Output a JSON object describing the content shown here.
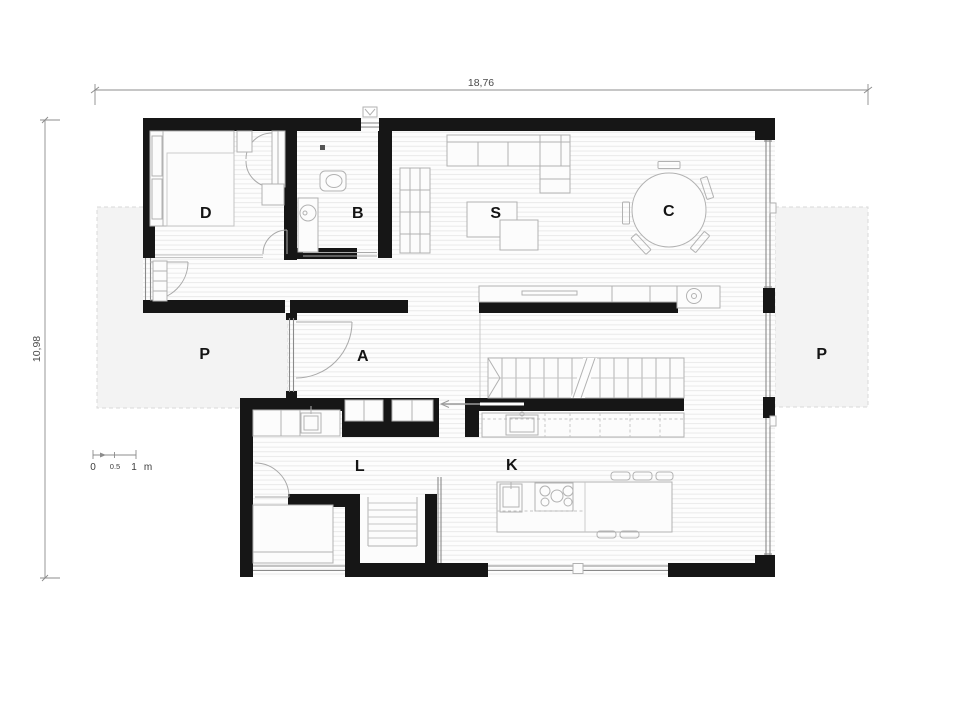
{
  "drawing": {
    "kind": "architectural floor plan"
  },
  "dimensions": {
    "overall_width": "18,76",
    "overall_height": "10,98"
  },
  "scale_bar": {
    "zero": "0",
    "half": "0.5",
    "one": "1",
    "unit": "m"
  },
  "room_labels": {
    "bedroom": "D",
    "bathroom": "B",
    "living_room": "S",
    "dining_area": "C",
    "entrance_hall": "A",
    "utility_room": "L",
    "kitchen": "K",
    "terrace_left": "P",
    "terrace_right": "P"
  },
  "colors": {
    "wall": "#161616",
    "terrace_fill": "#f3f3f3",
    "terrace_border": "#d9d9d9",
    "floor_line": "#e7e7e7",
    "furniture": "#b2b2b2",
    "dimension": "#8c8c8c"
  }
}
